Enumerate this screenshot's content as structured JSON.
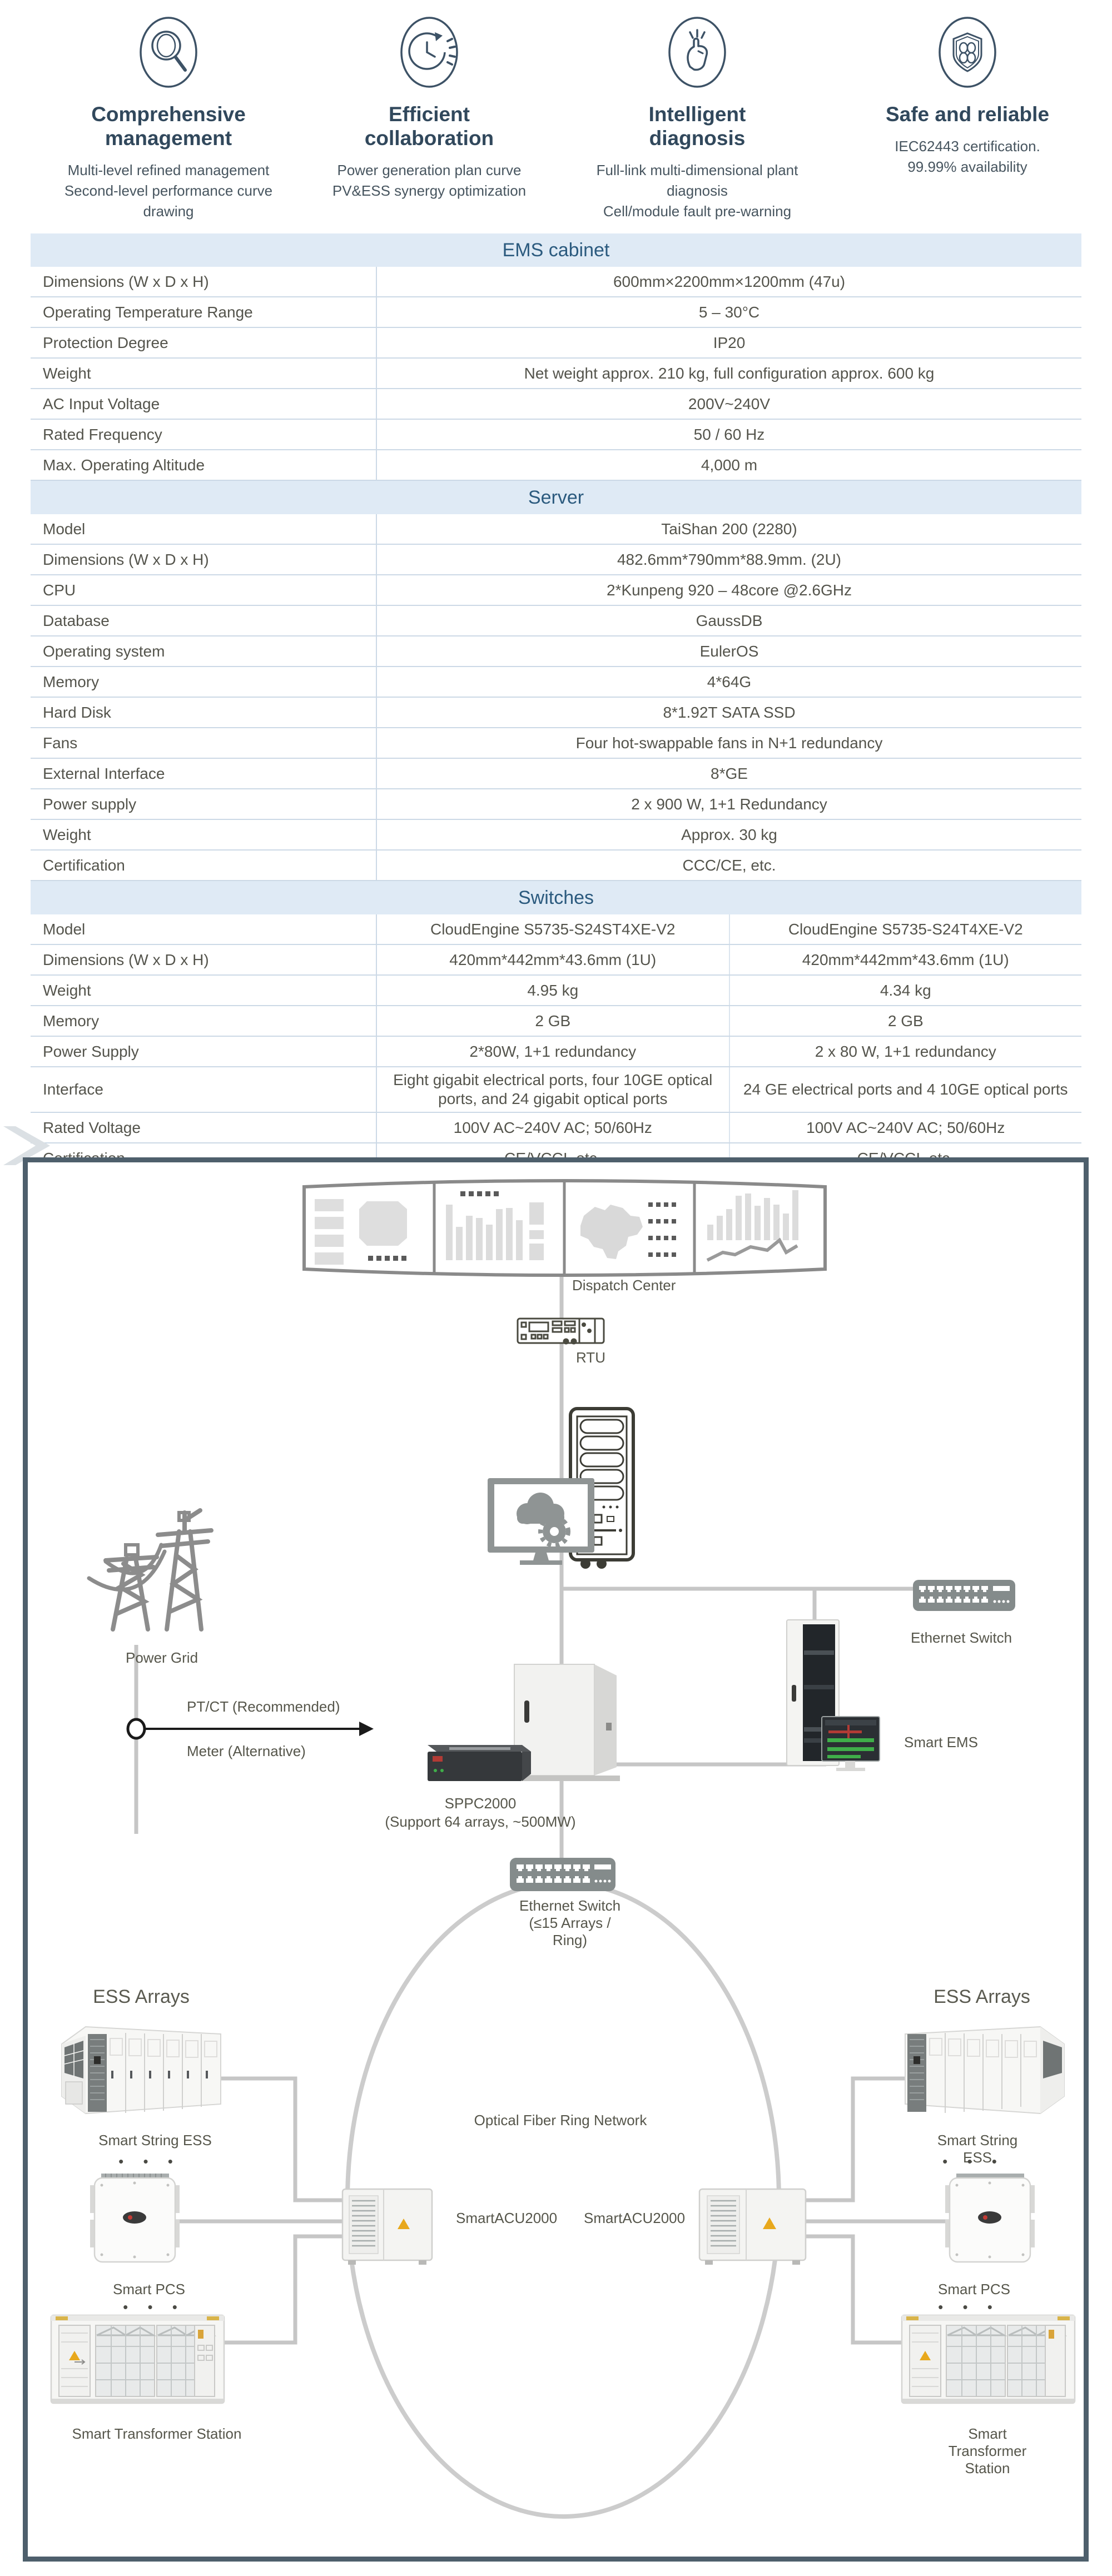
{
  "features": [
    {
      "icon": "magnifier-icon",
      "title": "Comprehensive\nmanagement",
      "subs": [
        "Multi-level refined management",
        "Second-level performance curve drawing"
      ]
    },
    {
      "icon": "clock-cycle-icon",
      "title": "Efficient\ncollaboration",
      "subs": [
        "Power generation plan curve",
        "PV&ESS synergy optimization"
      ]
    },
    {
      "icon": "finger-snap-icon",
      "title": "Intelligent\ndiagnosis",
      "subs": [
        "Full-link multi-dimensional plant diagnosis",
        "Cell/module fault pre-warning"
      ]
    },
    {
      "icon": "shield-clover-icon",
      "title": "Safe and reliable",
      "subs": [
        "IEC62443 certification.",
        "99.99% availability"
      ]
    }
  ],
  "tables": [
    {
      "title": "EMS cabinet",
      "value_cols": 1,
      "rows": [
        {
          "label": "Dimensions (W x D x H)",
          "values": [
            "600mm×2200mm×1200mm (47u)"
          ]
        },
        {
          "label": "Operating Temperature Range",
          "values": [
            "5 – 30°C"
          ]
        },
        {
          "label": "Protection Degree",
          "values": [
            "IP20"
          ]
        },
        {
          "label": "Weight",
          "values": [
            "Net weight approx. 210 kg, full configuration approx. 600 kg"
          ]
        },
        {
          "label": "AC Input Voltage",
          "values": [
            "200V~240V"
          ]
        },
        {
          "label": "Rated Frequency",
          "values": [
            "50 / 60 Hz"
          ]
        },
        {
          "label": "Max. Operating Altitude",
          "values": [
            "4,000 m"
          ]
        }
      ]
    },
    {
      "title": "Server",
      "value_cols": 1,
      "rows": [
        {
          "label": "Model",
          "values": [
            "TaiShan 200 (2280)"
          ]
        },
        {
          "label": "Dimensions (W x D x H)",
          "values": [
            "482.6mm*790mm*88.9mm. (2U)"
          ]
        },
        {
          "label": "CPU",
          "values": [
            "2*Kunpeng 920 – 48core @2.6GHz"
          ]
        },
        {
          "label": "Database",
          "values": [
            "GaussDB"
          ]
        },
        {
          "label": "Operating system",
          "values": [
            "EulerOS"
          ]
        },
        {
          "label": "Memory",
          "values": [
            "4*64G"
          ]
        },
        {
          "label": "Hard Disk",
          "values": [
            "8*1.92T SATA SSD"
          ]
        },
        {
          "label": "Fans",
          "values": [
            "Four hot-swappable fans in N+1 redundancy"
          ]
        },
        {
          "label": "External Interface",
          "values": [
            "8*GE"
          ]
        },
        {
          "label": "Power supply",
          "values": [
            "2 x 900 W, 1+1 Redundancy"
          ]
        },
        {
          "label": "Weight",
          "values": [
            "Approx. 30 kg"
          ]
        },
        {
          "label": "Certification",
          "values": [
            "CCC/CE, etc."
          ]
        }
      ]
    },
    {
      "title": "Switches",
      "value_cols": 2,
      "rows": [
        {
          "label": "Model",
          "values": [
            "CloudEngine S5735-S24ST4XE-V2",
            "CloudEngine S5735-S24T4XE-V2"
          ]
        },
        {
          "label": "Dimensions (W x D x H)",
          "values": [
            "420mm*442mm*43.6mm (1U)",
            "420mm*442mm*43.6mm (1U)"
          ]
        },
        {
          "label": "Weight",
          "values": [
            "4.95 kg",
            "4.34 kg"
          ]
        },
        {
          "label": "Memory",
          "values": [
            "2 GB",
            "2 GB"
          ]
        },
        {
          "label": "Power Supply",
          "values": [
            "2*80W, 1+1 redundancy",
            "2 x 80 W, 1+1 redundancy"
          ]
        },
        {
          "label": "Interface",
          "height": 80,
          "values": [
            "Eight gigabit electrical ports, four 10GE optical ports, and 24 gigabit optical ports",
            "24 GE electrical ports and 4 10GE optical ports"
          ]
        },
        {
          "label": "Rated Voltage",
          "values": [
            "100V AC~240V AC; 50/60Hz",
            "100V AC~240V AC; 50/60Hz"
          ]
        },
        {
          "label": "Certification",
          "values": [
            "CE/VCCI, etc.",
            "CE/VCCI, etc."
          ]
        }
      ]
    }
  ],
  "diagram": {
    "labels": {
      "dispatch_center": "Dispatch Center",
      "rtu": "RTU",
      "power_grid": "Power Grid",
      "ptct": "PT/CT (Recommended)",
      "meter": "Meter (Alternative)",
      "ethernet_switch_top": "Ethernet Switch",
      "smart_ems": "Smart EMS",
      "sppc_line1": "SPPC2000",
      "sppc_line2": "(Support 64 arrays, ~500MW)",
      "ethernet_switch_mid": "Ethernet Switch\n(≤15 Arrays /\nRing)",
      "ring_network": "Optical Fiber Ring Network",
      "smart_acu_left": "SmartACU2000",
      "smart_acu_right": "SmartACU2000",
      "ess_arrays_left": "ESS Arrays",
      "ess_arrays_right": "ESS Arrays",
      "string_ess_left": "Smart String ESS",
      "string_ess_right": "Smart String ESS",
      "smart_pcs_left": "Smart PCS",
      "smart_pcs_right": "Smart PCS",
      "transformer_left": "Smart Transformer Station",
      "transformer_right": "Smart Transformer Station",
      "dots": "• • •"
    }
  },
  "colors": {
    "accent_header_bg": "#dfeaf5",
    "accent_header_text": "#2b5a7e",
    "feature_title": "#31485c",
    "icon_stroke": "#3d5266",
    "table_border": "#ccd9e6",
    "diagram_border": "#4e5f6c",
    "connector": "#c6c6c6",
    "device_gray": "#848b8b",
    "warning_yellow": "#e8a81c",
    "screen_green": "#3fae49"
  }
}
